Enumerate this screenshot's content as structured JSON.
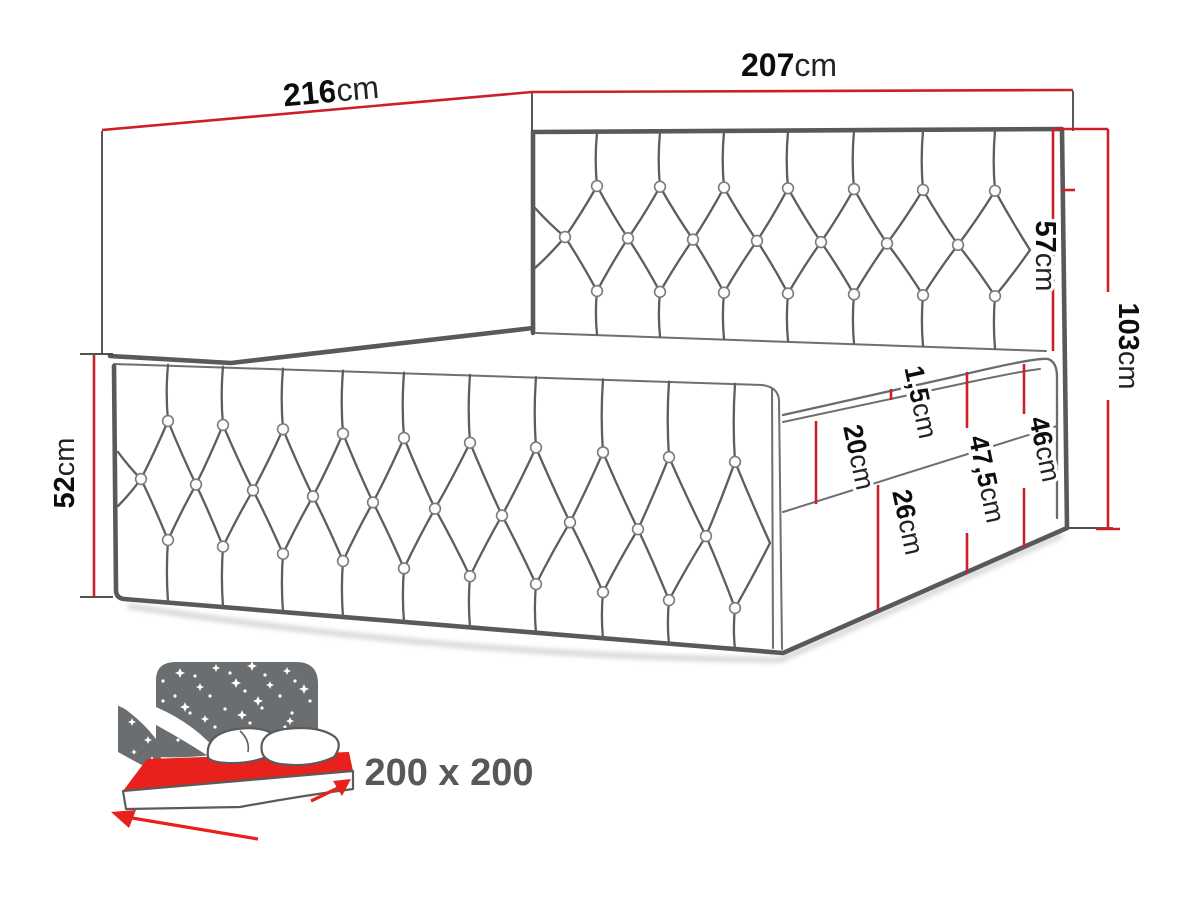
{
  "diagram": {
    "type": "bed-dimension-drawing",
    "size_label": "200 x 200",
    "dimensions": {
      "depth": {
        "value": "216",
        "unit": "cm"
      },
      "width": {
        "value": "207",
        "unit": "cm"
      },
      "headboard_above_base": {
        "value": "57",
        "unit": "cm"
      },
      "total_height": {
        "value": "103",
        "unit": "cm"
      },
      "front_panel_height": {
        "value": "52",
        "unit": "cm"
      },
      "topper_thickness": {
        "value": "1,5",
        "unit": "cm"
      },
      "mattress_height": {
        "value": "20",
        "unit": "cm"
      },
      "side_upper_height": {
        "value": "47,5",
        "unit": "cm"
      },
      "side_height": {
        "value": "46",
        "unit": "cm"
      },
      "base_height": {
        "value": "26",
        "unit": "cm"
      }
    },
    "colors": {
      "dimension_red": "#cb2026",
      "icon_red": "#e8211c",
      "outline_gray": "#58595b",
      "icon_gray": "#6b6e70",
      "size_label_gray": "#58585a"
    }
  }
}
